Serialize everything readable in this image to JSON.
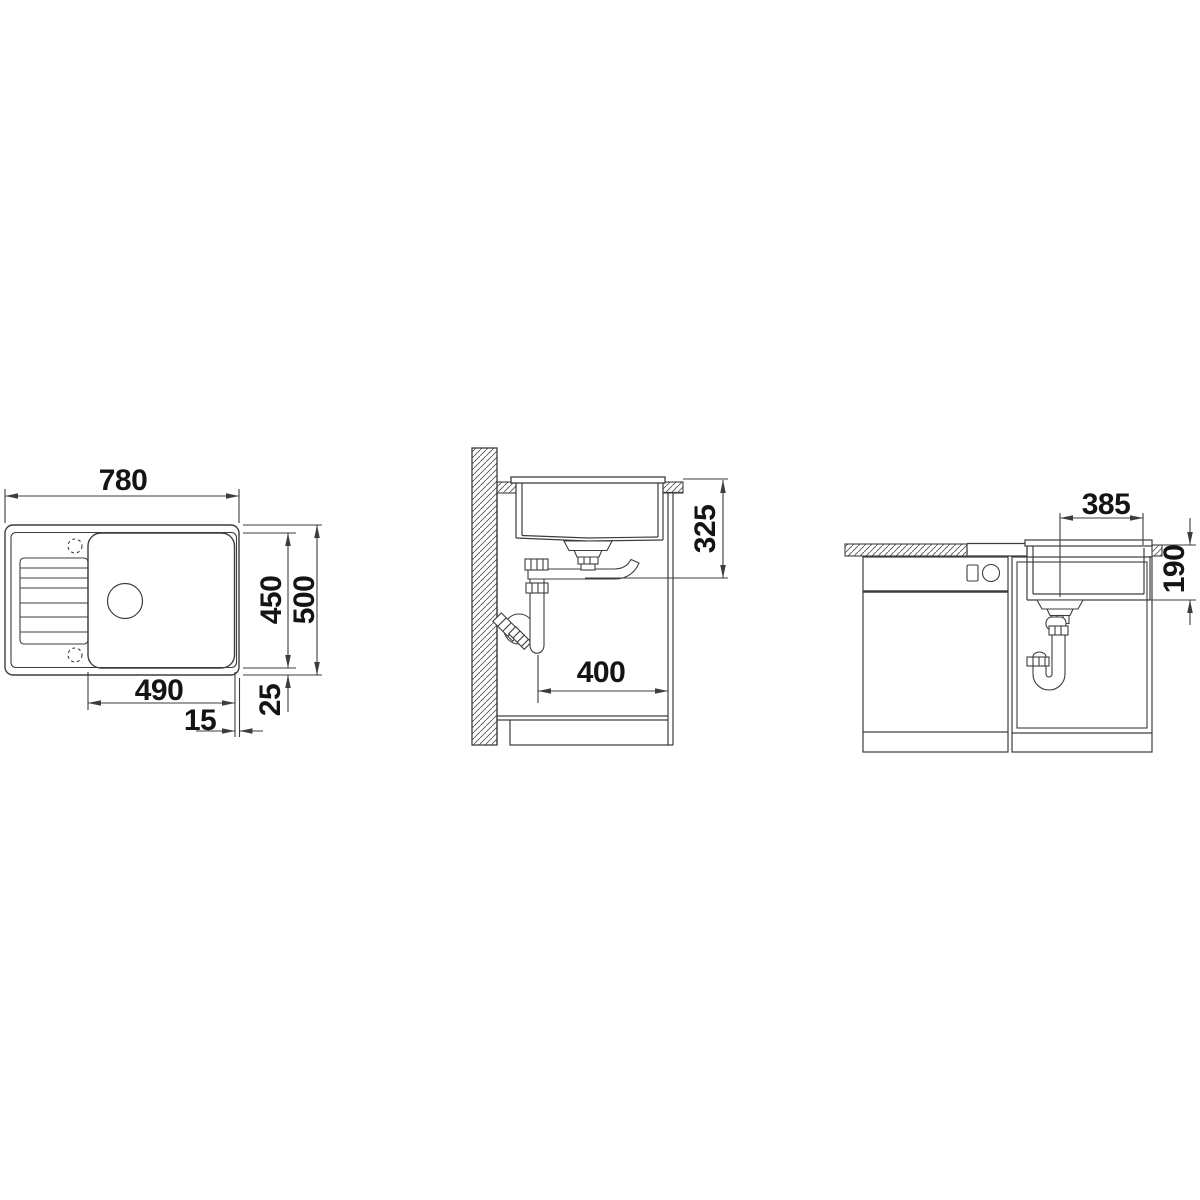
{
  "diagram": {
    "kind": "sink-installation-technical-drawing",
    "views": {
      "top": {
        "overall_width": "780",
        "bowl_width": "490",
        "rim_offset_right": "15",
        "inner_depth": "450",
        "overall_depth": "500",
        "rim_offset_bottom": "25"
      },
      "side": {
        "drain_depth": "325",
        "cabinet_clearance": "400"
      },
      "front": {
        "drain_to_edge": "385",
        "bowl_depth": "190"
      }
    },
    "colors": {
      "line": "#3d3d3d",
      "text": "#141414",
      "background": "#ffffff"
    }
  }
}
